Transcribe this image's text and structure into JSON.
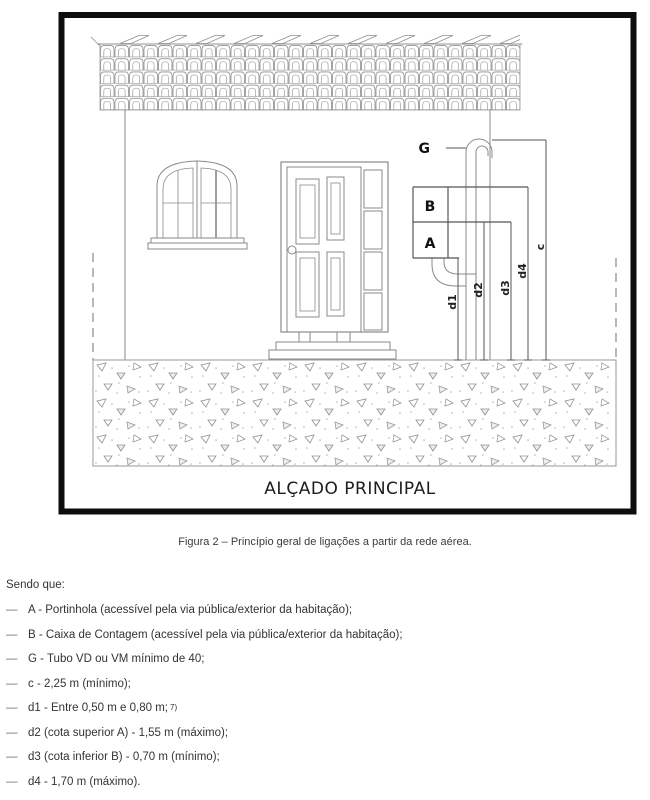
{
  "figure": {
    "title": "ALÇADO PRINCIPAL",
    "component_labels": {
      "g": "G",
      "b": "B",
      "a": "A"
    },
    "dimension_labels": {
      "d1": "d1",
      "d2": "d2",
      "d3": "d3",
      "d4": "d4",
      "c": "c"
    }
  },
  "caption": "Figura 2 – Princípio geral de ligações a partir da rede aérea.",
  "legend": {
    "intro": "Sendo que:",
    "dash": "—",
    "items": [
      {
        "text": "A - Portinhola (acessível pela via pública/exterior da habitação);"
      },
      {
        "text": "B - Caixa de Contagem (acessível pela via pública/exterior da habitação);"
      },
      {
        "text": "G - Tubo VD ou VM mínimo de 40;"
      },
      {
        "text": "c - 2,25 m (mínimo);"
      },
      {
        "text": "d1 - Entre 0,50 m e 0,80 m;",
        "footnote": "7)"
      },
      {
        "text": "d2 (cota superior A) - 1,55 m (máximo);"
      },
      {
        "text": "d3 (cota inferior B) - 0,70 m (mínimo);"
      },
      {
        "text": "d4 - 1,70 m (máximo)."
      }
    ]
  },
  "colors": {
    "frame": "#0d0d0d",
    "line": "#8a8a8a",
    "dim_line": "#555555",
    "text": "#333333"
  }
}
